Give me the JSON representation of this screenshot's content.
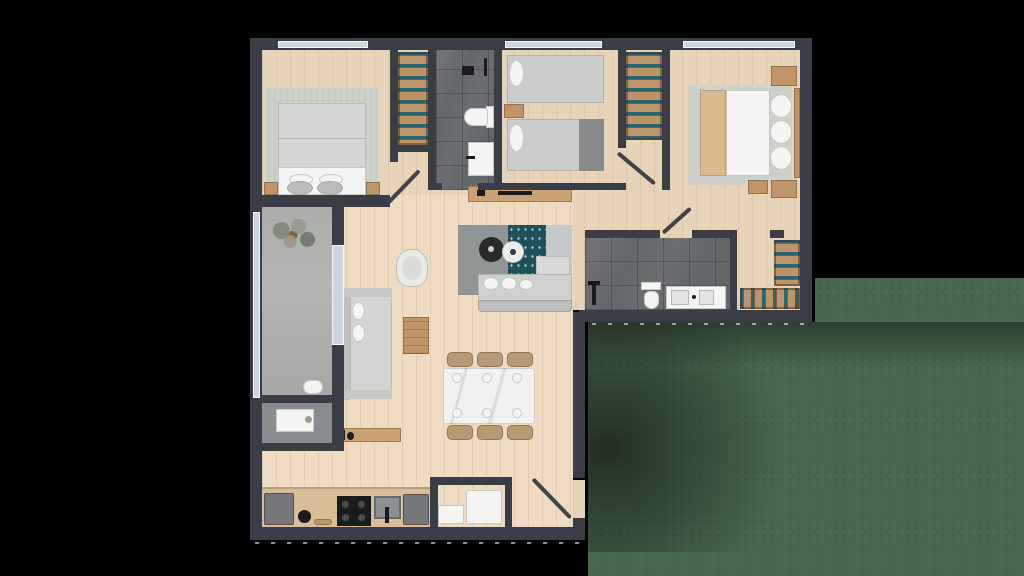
{
  "scene": {
    "type": "floor-plan",
    "view": "top-down-3d-render",
    "description": "Rendered top-down floor plan of an L-shaped apartment with three bedrooms, two bathrooms, open living-dining-kitchen, balcony, utility room and entry, set on a dark lawn"
  },
  "palette": {
    "background": "#000000",
    "lawn": "#4a684e",
    "wall": "#3a3d45",
    "floor": "#e7d3b7",
    "floor_light": "#eedbc1",
    "balcony": "#b5b6b4",
    "utility": "#8a8d90",
    "tile": "#64676a",
    "rug_sage": "#c8cec3",
    "rug_gray": "#8f9594",
    "rug_teal": "#20505a",
    "rug_light": "#c5c9c7",
    "wood": "#bf9468",
    "fabric": "#d4d6d3",
    "white": "#f4f5f2",
    "appliance": "#75777a",
    "black": "#1a1b1d",
    "teal": "#2b6472",
    "glass": "#ccd6da",
    "door": "#3f434c"
  },
  "rooms": [
    {
      "id": "bedroom-1",
      "furniture": [
        "double-bed",
        "area-rug",
        "nightstand-left",
        "nightstand-right",
        "closet-with-hangers"
      ]
    },
    {
      "id": "bathroom-1",
      "furniture": [
        "shower-fixture",
        "toilet",
        "sink-vanity"
      ]
    },
    {
      "id": "bedroom-2",
      "furniture": [
        "single-bed",
        "single-bed",
        "nightstand",
        "closet-with-hangers"
      ]
    },
    {
      "id": "master-bedroom",
      "furniture": [
        "double-bed",
        "area-rug",
        "nightstand-top",
        "nightstand-bottom",
        "dresser"
      ]
    },
    {
      "id": "master-bathroom",
      "furniture": [
        "shower-fixture",
        "toilet",
        "double-sink-vanity"
      ]
    },
    {
      "id": "walk-in-closet",
      "furniture": [
        "hanging-rail-east",
        "hanging-rail-south"
      ]
    },
    {
      "id": "hallway",
      "furniture": [
        "media-console"
      ]
    },
    {
      "id": "living-room",
      "furniture": [
        "sofa",
        "chaise-section",
        "second-sofa",
        "armchair",
        "wood-coffee-table",
        "round-table-dark",
        "round-table-white",
        "three-panel-rug"
      ]
    },
    {
      "id": "dining-area",
      "furniture": [
        "marble-dining-table",
        "chair-1",
        "chair-2",
        "chair-3",
        "chair-4",
        "chair-5",
        "chair-6",
        "place-settings"
      ]
    },
    {
      "id": "kitchen",
      "furniture": [
        "refrigerator",
        "kettle",
        "cutting-board",
        "cooktop",
        "sink",
        "oven",
        "counter",
        "wall-shelf"
      ]
    },
    {
      "id": "entry",
      "furniture": [
        "entry-door",
        "closet",
        "washer",
        "storage-box"
      ]
    },
    {
      "id": "balcony",
      "furniture": [
        "plant",
        "stool",
        "glass-sliding-door"
      ]
    },
    {
      "id": "utility-room",
      "furniture": [
        "washing-machine"
      ]
    }
  ],
  "exterior": {
    "lawn": "dark green, lower-right of plan",
    "paving_dashes": "small light dashes along south walls",
    "windows": [
      "bedroom-1-north",
      "bedroom-2-north",
      "master-north",
      "balcony-west"
    ]
  }
}
